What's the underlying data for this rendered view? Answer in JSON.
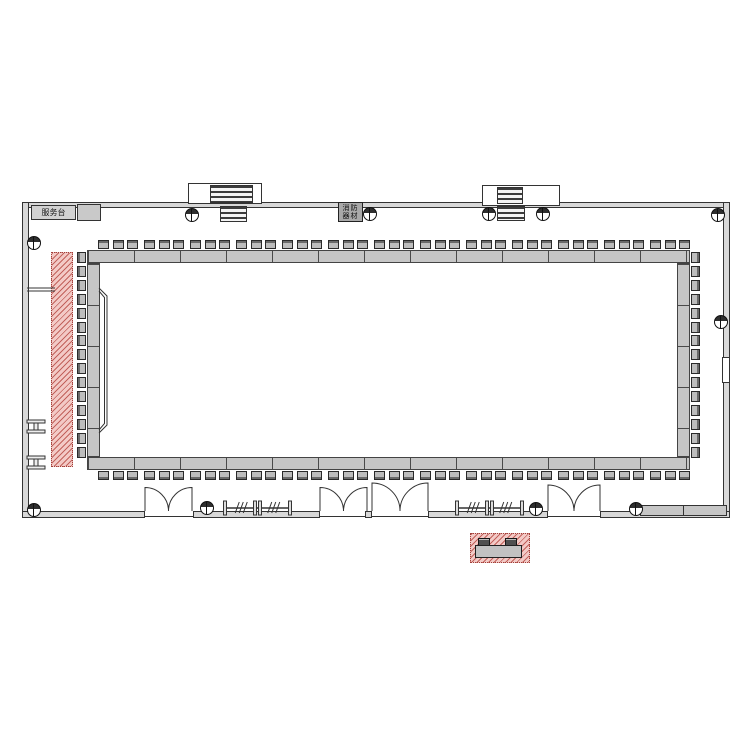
{
  "labels": {
    "service_desk": "服务台",
    "equipment_line1": "消防",
    "equipment_line2": "器材"
  },
  "plan": {
    "colors": {
      "wall_fill": "#d8d8d8",
      "band_fill": "#c6c6c6",
      "seat_fill": "#bdbdbd",
      "hatch_pink": "#f3cac6",
      "hatch_red_line": "#b23e38",
      "line": "#333333"
    },
    "seats": {
      "top_groups": 13,
      "per_group": 3,
      "bottom_groups": 13,
      "left_count": 15,
      "right_count": 15
    },
    "columns": [
      [
        34,
        243
      ],
      [
        192,
        215
      ],
      [
        370,
        214
      ],
      [
        489,
        214
      ],
      [
        543,
        214
      ],
      [
        718,
        215
      ],
      [
        721,
        322
      ],
      [
        34,
        510
      ],
      [
        207,
        508
      ],
      [
        536,
        509
      ],
      [
        636,
        509
      ]
    ],
    "doors": [
      [
        145,
        192
      ],
      [
        320,
        367
      ],
      [
        372,
        428
      ],
      [
        548,
        600
      ]
    ],
    "railings": [
      [
        225,
        290
      ],
      [
        457,
        522
      ]
    ]
  }
}
